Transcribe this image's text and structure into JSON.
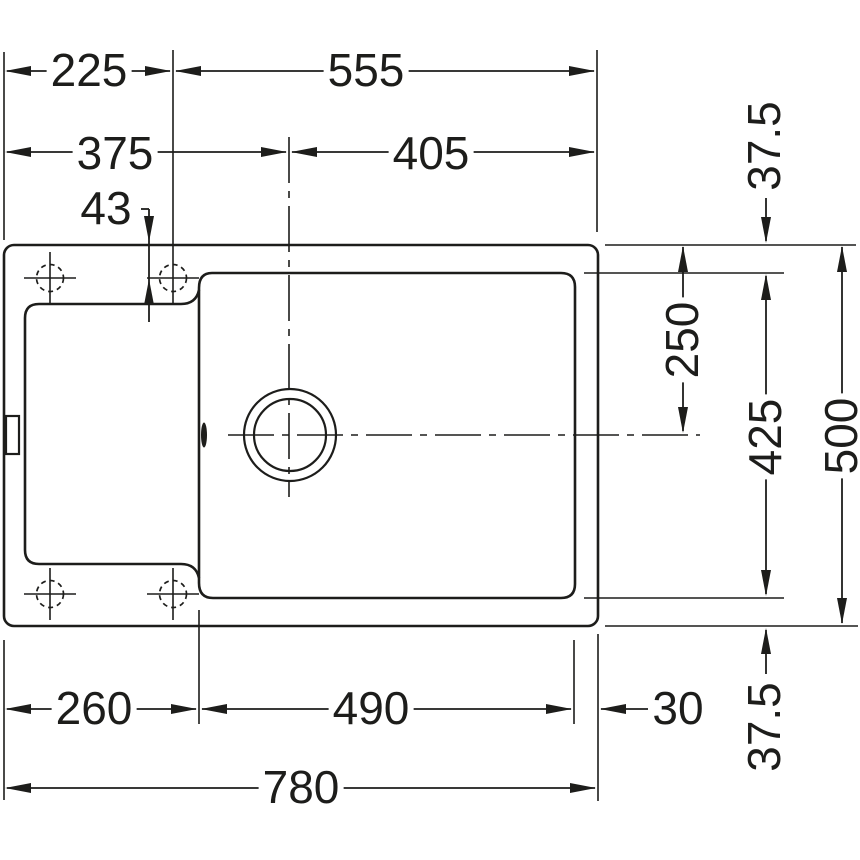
{
  "colors": {
    "line": "#1d1d1b",
    "background": "#ffffff"
  },
  "dims": {
    "top_left_width": "225",
    "top_right_width": "555",
    "left_to_bowl_center": "375",
    "bowl_center_to_right": "405",
    "tap_hole_offset": "43",
    "rear_margin": "37.5",
    "drain_center_depth": "250",
    "bowl_depth": "425",
    "overall_depth": "500",
    "front_margin": "37.5",
    "left_to_bowl": "260",
    "bowl_width": "490",
    "bowl_margin_right": "30",
    "overall_width": "780"
  }
}
